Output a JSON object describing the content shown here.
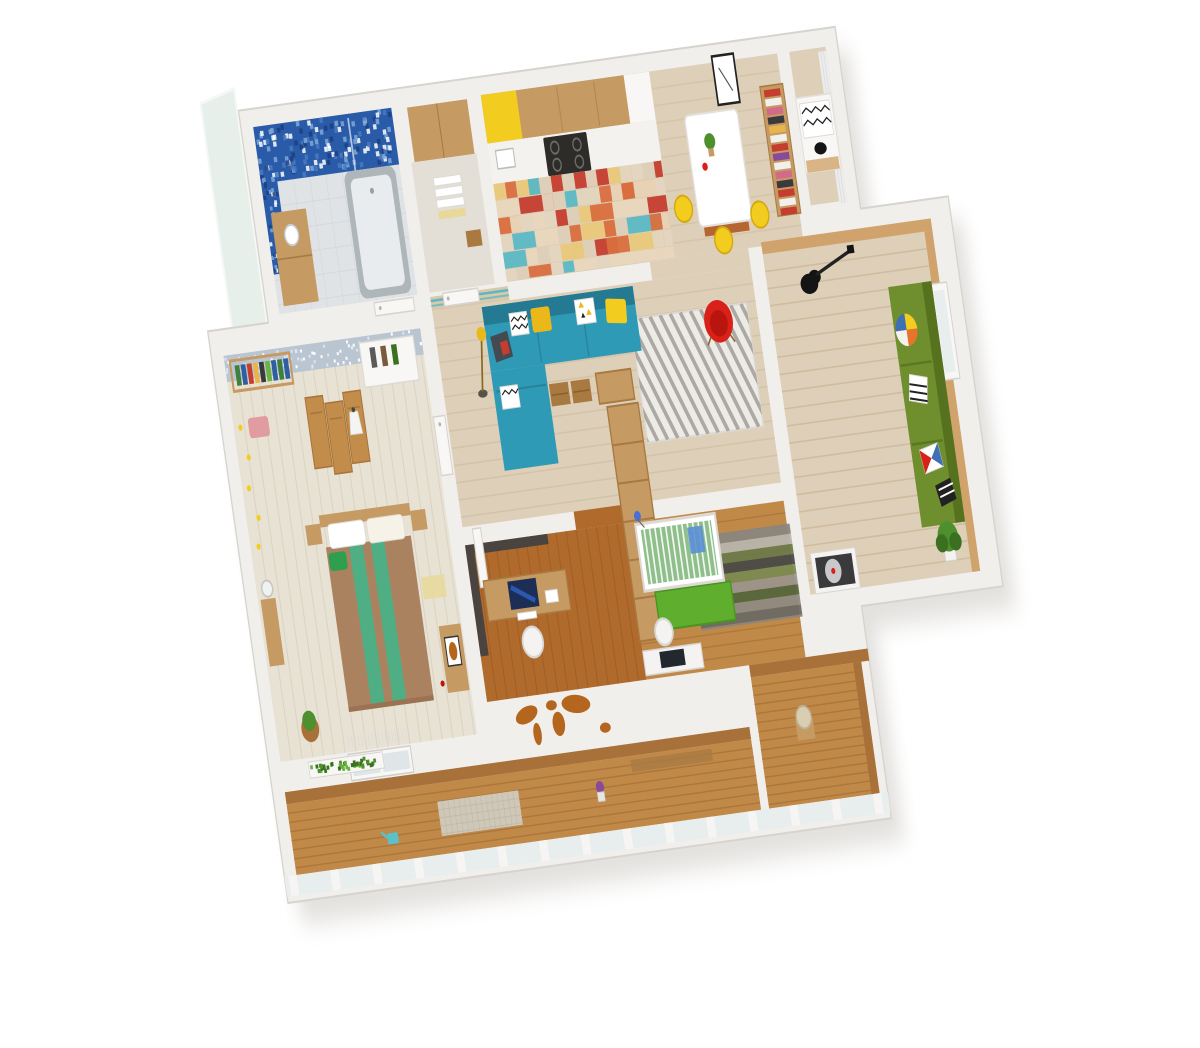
{
  "scene": {
    "kind": "isometric-3d-apartment-floorplan-render",
    "rooms": [
      "bathroom",
      "laundry-storage",
      "kitchen",
      "dining-area",
      "window-seat-nook",
      "living-room",
      "home-office",
      "nursery",
      "kids-music-room",
      "master-bedroom",
      "hallway",
      "glazed-balcony",
      "corner-balcony"
    ],
    "furniture": [
      "bathtub",
      "mosaic-wall",
      "towel-shelf",
      "gas-stove",
      "yellow-cabinet",
      "dining-table",
      "bar-stools",
      "bookshelf",
      "teal-corner-sofa",
      "yellow-pillows",
      "floor-lamp",
      "chevron-rug",
      "red-shell-chair",
      "storage-baskets",
      "shelving-divider",
      "desk-with-monitor",
      "desk-chair",
      "baby-crib",
      "green-rug",
      "striped-rug",
      "green-sofa",
      "star-pillow",
      "electric-guitar",
      "record-player",
      "potted-plant",
      "double-bed",
      "folding-screen",
      "bird-wallpaper",
      "string-lights",
      "tv-stand",
      "world-map-mural",
      "flower-box",
      "balcony-stool",
      "watering-can"
    ]
  },
  "colors": {
    "wall": "#f1efec",
    "wall_edge": "#d7d4cf",
    "shadow": "#e3e1de",
    "glass_panel": "#e3ede7",
    "floor_light": "#decfb8",
    "plank": "#cbb99f",
    "floor_bedroom": "#e8e2d4",
    "bedroom_plank": "#d9d2c0",
    "floor_office": "#b06a2c",
    "office_plank": "#935423",
    "floor_mid": "#c08948",
    "balcony_plank": "#8f5c2b",
    "tile": "#dfe3e6",
    "tile_line": "#c9cdd2",
    "laundry_floor": "#e3dfd6",
    "mosaic": "#2a5ba8",
    "wood": "#c69a63",
    "wood_dark": "#a87a42",
    "wood_panel": "#cfa36b",
    "screen_wood": "#c28d4a",
    "yellow": "#f2cc1f",
    "yellow_deep": "#eab818",
    "counter": "#f4f2ee",
    "stove": "#2e2c29",
    "sofa_teal": "#2f9ab5",
    "sofa_teal_dark": "#237a92",
    "red": "#d92019",
    "red_dark": "#b8150f",
    "rug_bg": "#edebe6",
    "rug_stripe": "#a09d97",
    "green_sofa": "#6f8f2f",
    "green_sofa_dark": "#57721f",
    "rug_green": "#5fae2e",
    "crib_green": "#8fbf8a",
    "dark_wall": "#4a4440",
    "wallpaper": "#bac5d2",
    "blanket": "#ab8260",
    "runner": "#4fae83",
    "pillow_green": "#2e9e4f",
    "cork": "#a9713a",
    "map": "#b5661e",
    "plant": "#4e8f2e",
    "plant_dark": "#3a7020",
    "tub": "#aeb6ba",
    "tub_inner": "#e8ecee",
    "white": "#f8f7f5",
    "glass": "#e8eeee",
    "glass_door": "#dfe6e8",
    "turntable": "#3a3a3c",
    "disc": "#c9c9cc",
    "black": "#141414",
    "pink": "#e09ca0",
    "purple": "#8a4a9a",
    "teal_can": "#5bc0c8",
    "curtain": "#ececed",
    "mat": "#e8d89a",
    "brick": "#b5652f",
    "hall_wood": "#d8c8ac",
    "hall_teal": "#4fb7c6",
    "monitor": "#1c2e56",
    "monitor_glow": "#2f62c4",
    "screen_dark": "#23272e",
    "chair_white": "#f4f3f1",
    "chair_stroke": "#d8d6d2"
  },
  "textures": [
    {
      "id": "tx-bathgrid",
      "type": "grid",
      "x": 10,
      "y": 66,
      "w": 205,
      "h": 129,
      "step": 24,
      "color": "#c9cdd2",
      "op": 0.45,
      "sw": 1
    },
    {
      "id": "tx-mosaic",
      "type": "speckle",
      "x": 10,
      "y": 10,
      "w": 205,
      "h": 56,
      "n": 150,
      "s": 5,
      "colors": [
        "#7fa8d9",
        "#1c3f7e",
        "#ffffff",
        "#4a7ac0"
      ],
      "seed": 7,
      "op": 0.85
    },
    {
      "id": "tx-mosaic2",
      "type": "speckle",
      "x": 10,
      "y": 56,
      "w": 24,
      "h": 100,
      "n": 45,
      "s": 4,
      "colors": [
        "#7fa8d9",
        "#1c3f7e",
        "#ffffff"
      ],
      "seed": 13,
      "op": 0.85
    },
    {
      "id": "tx-kitchentiles",
      "type": "patch",
      "x": 348,
      "y": 98,
      "w": 250,
      "h": 97,
      "cell": 17,
      "colors": [
        "#e8d7bd",
        "#d96f3f",
        "#5bb8c4",
        "#c43d2e",
        "#e8c87a",
        "#e3d5c0",
        "#e8d7bd",
        "#e3d5c0",
        "#d96f3f",
        "#e8d7bd"
      ],
      "seed": 11,
      "op": 0.95
    },
    {
      "id": "tx-livingplanks",
      "type": "hlines",
      "x": 233,
      "y": 213,
      "w": 473,
      "h": 214,
      "step": 17,
      "color": "#cbb99f",
      "op": 0.5,
      "sw": 1.6
    },
    {
      "id": "tx-diningplanks",
      "type": "hlines",
      "x": 598,
      "y": 10,
      "w": 190,
      "h": 185,
      "step": 17,
      "color": "#cbb99f",
      "op": 0.45,
      "sw": 1.6
    },
    {
      "id": "tx-kidsplanks",
      "type": "hlines",
      "x": 726,
      "y": 203,
      "w": 240,
      "h": 337,
      "step": 17,
      "color": "#c3ab87",
      "op": 0.5,
      "sw": 1.6
    },
    {
      "id": "tx-officeplanks",
      "type": "vlines",
      "x": 233,
      "y": 445,
      "w": 237,
      "h": 155,
      "step": 15,
      "color": "#935423",
      "op": 0.5,
      "sw": 1.6
    },
    {
      "id": "tx-nurseryplanks",
      "type": "hlines",
      "x": 470,
      "y": 445,
      "w": 236,
      "h": 155,
      "step": 12,
      "color": "#8f5c2b",
      "op": 0.35,
      "sw": 1.4
    },
    {
      "id": "tx-bedroomplanks",
      "type": "vlines",
      "x": -80,
      "y": 254,
      "w": 292,
      "h": 376,
      "step": 16,
      "color": "#d9d2c0",
      "op": 0.85,
      "sw": 1.6
    },
    {
      "id": "tx-balconyplanks",
      "type": "hlines",
      "x": -80,
      "y": 672,
      "w": 690,
      "h": 70,
      "step": 9,
      "color": "#8f5c2b",
      "op": 0.4,
      "sw": 1.4
    },
    {
      "id": "tx-rbalconyplanks",
      "type": "hlines",
      "x": 622,
      "y": 612,
      "w": 164,
      "h": 130,
      "step": 9,
      "color": "#8f5c2b",
      "op": 0.4,
      "sw": 1.4
    },
    {
      "id": "tx-wallpaper",
      "type": "speckle",
      "x": -80,
      "y": 228,
      "w": 292,
      "h": 26,
      "n": 80,
      "s": 3,
      "colors": [
        "#ffffff",
        "#dfe6ee"
      ],
      "seed": 5,
      "op": 0.9
    },
    {
      "id": "tx-chevron",
      "type": "dlines",
      "x": 520,
      "y": 248,
      "w": 172,
      "h": 122,
      "step": 15,
      "slope": 0.5,
      "color": "#a09d97",
      "sw": 5,
      "op": 0.85
    },
    {
      "id": "tx-stripedrug",
      "type": "stripes",
      "x": 560,
      "y": 468,
      "w": 150,
      "h": 92,
      "step": 10,
      "colors": [
        "#8a8680",
        "#b8b4ac",
        "#6b7a4a",
        "#4a4a48",
        "#7b8a52",
        "#9b948a",
        "#55663e",
        "#8f8a82",
        "#6d6a64"
      ],
      "op": 0.95
    },
    {
      "id": "tx-cribslats",
      "type": "vlines",
      "x": 489,
      "y": 452,
      "w": 108,
      "h": 58,
      "step": 8,
      "color": "#ffffff",
      "op": 0.9,
      "sw": 2.4
    },
    {
      "id": "tx-books1",
      "type": "books",
      "x": 760,
      "y": 44,
      "w": 26,
      "h": 120,
      "step": 9,
      "colors": [
        "#c43d2e",
        "#f2f0ec",
        "#d46a8a",
        "#3a3a3c",
        "#e8b54a",
        "#f2f0ec",
        "#c43d2e",
        "#8a4a9a",
        "#f2f0ec",
        "#d46a8a",
        "#3a3a3c",
        "#c43d2e",
        "#f2f0ec"
      ],
      "op": 1
    },
    {
      "id": "tx-books2",
      "type": "booksh",
      "x": -66,
      "y": 238,
      "w": 78,
      "h": 22,
      "step": 9,
      "colors": [
        "#3f7f3f",
        "#2f5f9f",
        "#c43d2e",
        "#e8b54a",
        "#3a3a3c",
        "#6ab33e",
        "#2f5f9f"
      ],
      "op": 1
    },
    {
      "id": "tx-mullions",
      "type": "bars",
      "x": -92,
      "y": 742,
      "w": 884,
      "h": 20,
      "step": 62,
      "bw": 12,
      "color": "#f6f5f3",
      "op": 1
    },
    {
      "id": "tx-rmullions",
      "type": "bars",
      "x": 700,
      "y": 612,
      "w": 86,
      "h": 130,
      "step": 200,
      "bw": 0,
      "color": "#f6f5f3",
      "op": 0
    },
    {
      "id": "tx-rugdots",
      "type": "grid",
      "x": 140,
      "y": 690,
      "w": 120,
      "h": 34,
      "step": 8,
      "color": "#b8b0a0",
      "op": 0.55,
      "sw": 1
    },
    {
      "id": "tx-flowerbox",
      "type": "speckle",
      "x": -38,
      "y": 636,
      "w": 106,
      "h": 12,
      "n": 42,
      "s": 4,
      "colors": [
        "#4e8f2e",
        "#3a7020",
        "#6ab33e"
      ],
      "seed": 9,
      "op": 1
    },
    {
      "id": "tx-curtain",
      "type": "vlines",
      "x": 848,
      "y": 14,
      "w": 12,
      "h": 150,
      "step": 4,
      "color": "#d8d9da",
      "op": 0.8,
      "sw": 1.2
    },
    {
      "id": "tx-bedcurtain",
      "type": "vlines",
      "x": 18,
      "y": 614,
      "w": 96,
      "h": 12,
      "step": 5,
      "color": "#d8dadb",
      "op": 0.8,
      "sw": 1.2
    }
  ]
}
